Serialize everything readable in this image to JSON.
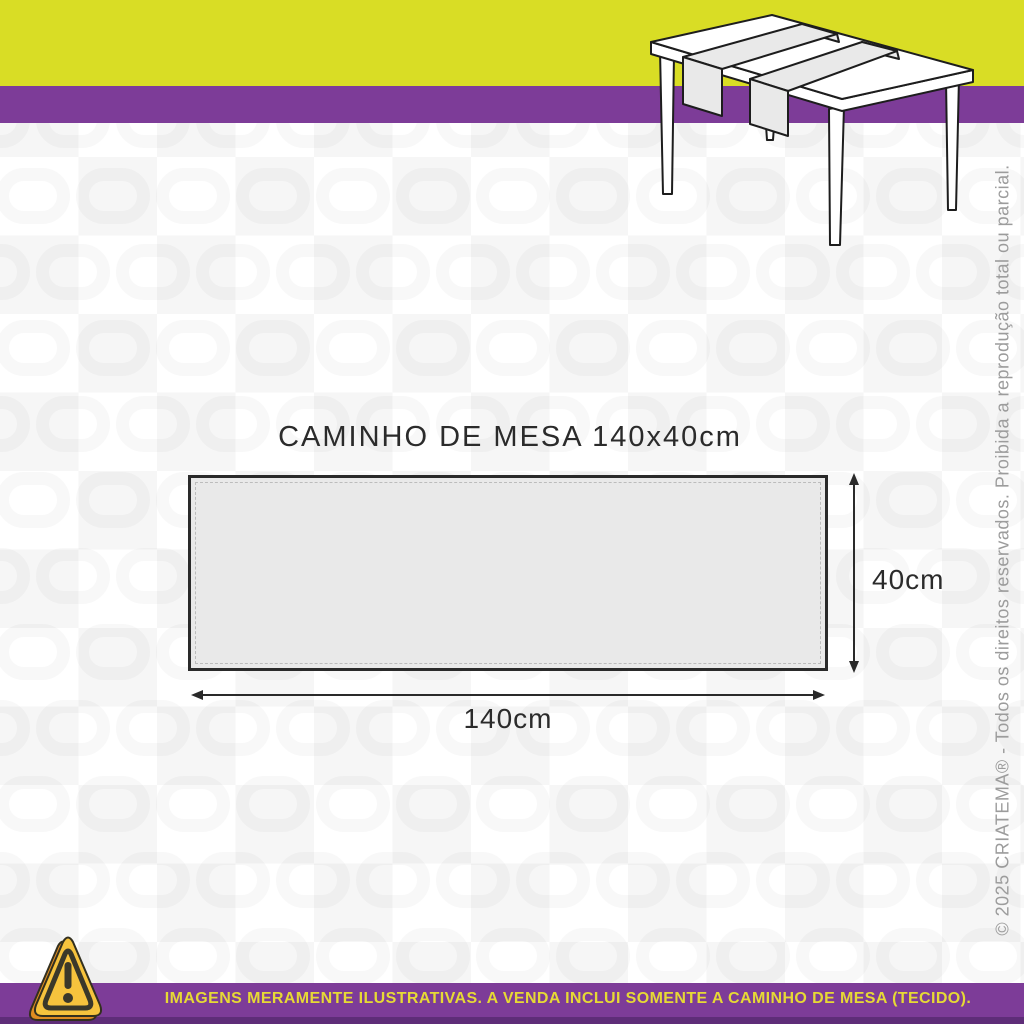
{
  "header": {
    "title": "MEDIDAS",
    "subtitle": "CAMINHO DE MESA"
  },
  "diagram": {
    "title": "CAMINHO DE MESA 140x40cm",
    "width_label": "140cm",
    "height_label": "40cm",
    "width_cm": 140,
    "height_cm": 40,
    "shape": "rectangle with dashed stitch border"
  },
  "illustration": {
    "description": "line drawing of a dining table with two fabric table runners draped across it"
  },
  "warning": {
    "text": "IMAGENS MERAMENTE ILUSTRATIVAS. A VENDA INCLUI SOMENTE A CAMINHO DE MESA (TECIDO)."
  },
  "copyright": {
    "text": "© 2025 CRIATEMA® - Todos os direitos reservados. Proibida a reprodução total ou parcial."
  },
  "icons": {
    "warning_triangle": "warning-triangle-icon"
  },
  "colors": {
    "brand_yellow": "#d9dd25",
    "brand_purple": "#7d3c98",
    "purple_dark": "#5e2d78",
    "runner_fill": "#e9e9e9",
    "outline": "#222222",
    "dim_text": "#2b2b2b",
    "copyright_gray": "#9c9c9c",
    "warning_icon_yellow": "#f6c33d",
    "warning_icon_orange": "#df8c20",
    "warning_icon_dark": "#3a382a"
  }
}
